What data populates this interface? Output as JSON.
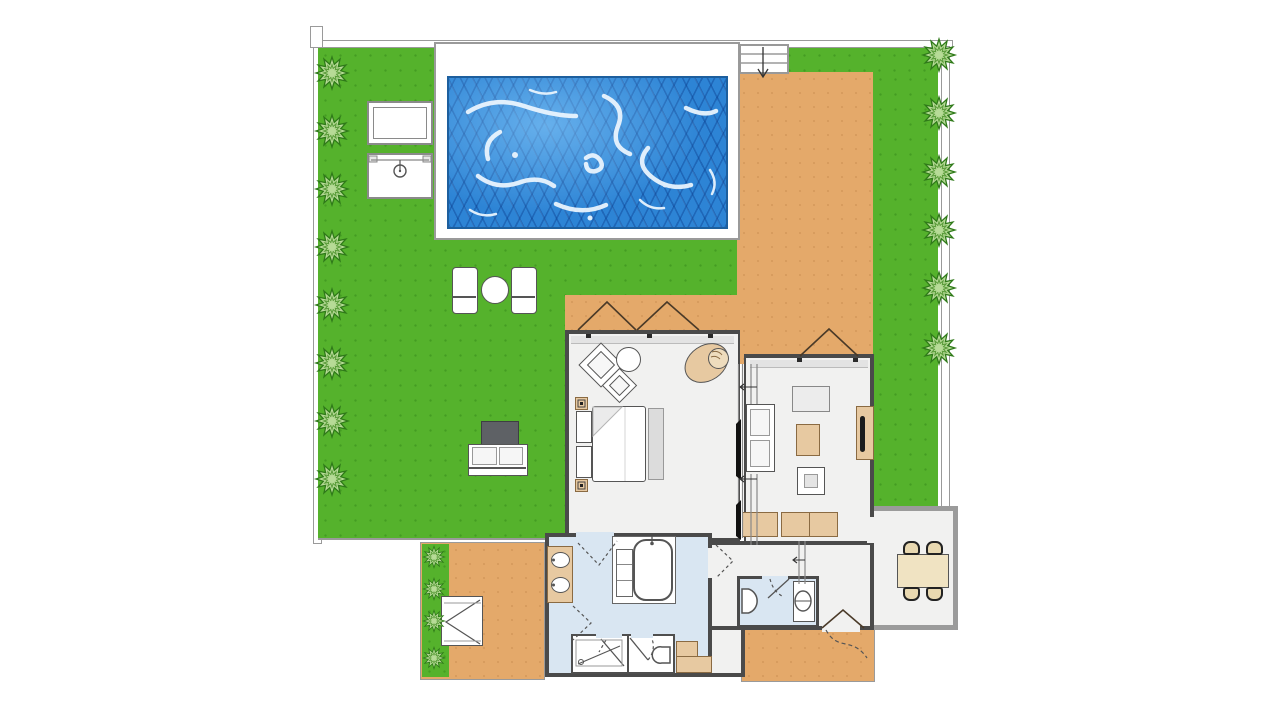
{
  "plan": {
    "title": "villa-floor-plan-with-pool-and-garden",
    "areas": [
      "garden-lawn",
      "swimming-pool",
      "pool-terrace",
      "wooden-deck",
      "entry-steps",
      "bedroom",
      "living-room",
      "bathroom",
      "shower-room",
      "toilet-room",
      "guest-wc",
      "hallway",
      "dining-room",
      "side-patio",
      "rear-deck"
    ],
    "counts": {
      "bushes_left": 8,
      "bushes_right": 6,
      "bushes_patio": 4,
      "dining_chairs": 4,
      "sun_loungers": 2,
      "vanity_sinks": 2,
      "toilets": 3,
      "window_swings": 3
    }
  },
  "palette": {
    "lawn": "#55b22c",
    "deck": "#e4a96a",
    "pool_water": "#2d84d5",
    "pool_lattice": "#0a4593",
    "pool_highlight": "#eef7ff",
    "floor": "#f1f1f0",
    "bath_floor": "#d9e6f2",
    "wall": "#4a4a4a",
    "annex_wall": "#9b9b9b",
    "fence": "#ffffff",
    "fence_border": "#9a9a9a",
    "bush_fill": "#b7db97",
    "bush_stroke": "#2f7a19",
    "furniture_tan": "#e7c9a1",
    "furniture_gray": "#dcdcdc",
    "table_dark": "#5e6165",
    "dining_table": "#f0e3c2",
    "tv": "#1c1c1c",
    "line": "#555555",
    "background": "#ffffff"
  },
  "furniture": {
    "garden": [
      "sun-lounger",
      "round-table",
      "sun-lounger",
      "dark-table",
      "outdoor-sofa"
    ],
    "pool_area": [
      "pool-side-table",
      "barbecue-grill"
    ],
    "bedroom": [
      "double-bed",
      "nightstand",
      "nightstand",
      "bedside-lamp",
      "bedside-lamp",
      "bench",
      "lounge-chair",
      "lounge-chair",
      "side-table",
      "egg-chair"
    ],
    "living_room": [
      "sofa",
      "console-table",
      "coffee-table",
      "pouf",
      "tv-cabinet",
      "tv",
      "sideboard",
      "sideboard"
    ],
    "bathroom": [
      "double-vanity",
      "bathtub",
      "bath-cabinet",
      "shower",
      "toilet",
      "corner-counter"
    ],
    "guest_wc": [
      "toilet",
      "wash-basin"
    ],
    "dining_room": [
      "dining-table",
      "chair",
      "chair",
      "chair",
      "chair"
    ],
    "side_patio": [
      "outdoor-shower-tray"
    ]
  },
  "icons": {
    "bush": "star-burst-shrub",
    "window_swing": "triangle-casement",
    "door_swing": "dashed-arc",
    "sliding_door": "double-track-with-leaf",
    "entry_steps": "stairs-with-arrow",
    "grill": "circle-dial",
    "drain": "small-circle"
  }
}
